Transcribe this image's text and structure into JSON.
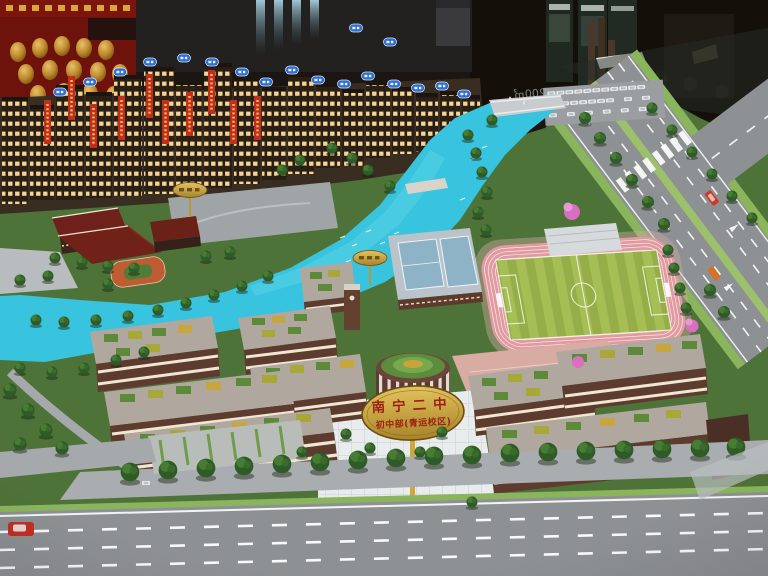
{
  "signs": {
    "main": {
      "line1": "南宁二中",
      "line2": "初中部(青运校区)"
    },
    "glass_reflection": "1703-200㎡"
  },
  "colors": {
    "river": "#38c3de",
    "lake": "#2fb6d2",
    "track": "#e09aa0",
    "pitch_light": "#a6bf54",
    "pitch_dark": "#95ae47",
    "road": "#8e9194",
    "grass": "#4e7338",
    "sign_gold": "#cfa83d",
    "banner_red": "#c22d1c",
    "tag_blue": "#2e6fd0",
    "building_brown": "#5d3b2f",
    "plaza": "#e9eced",
    "median_green": "#8ab55c"
  }
}
